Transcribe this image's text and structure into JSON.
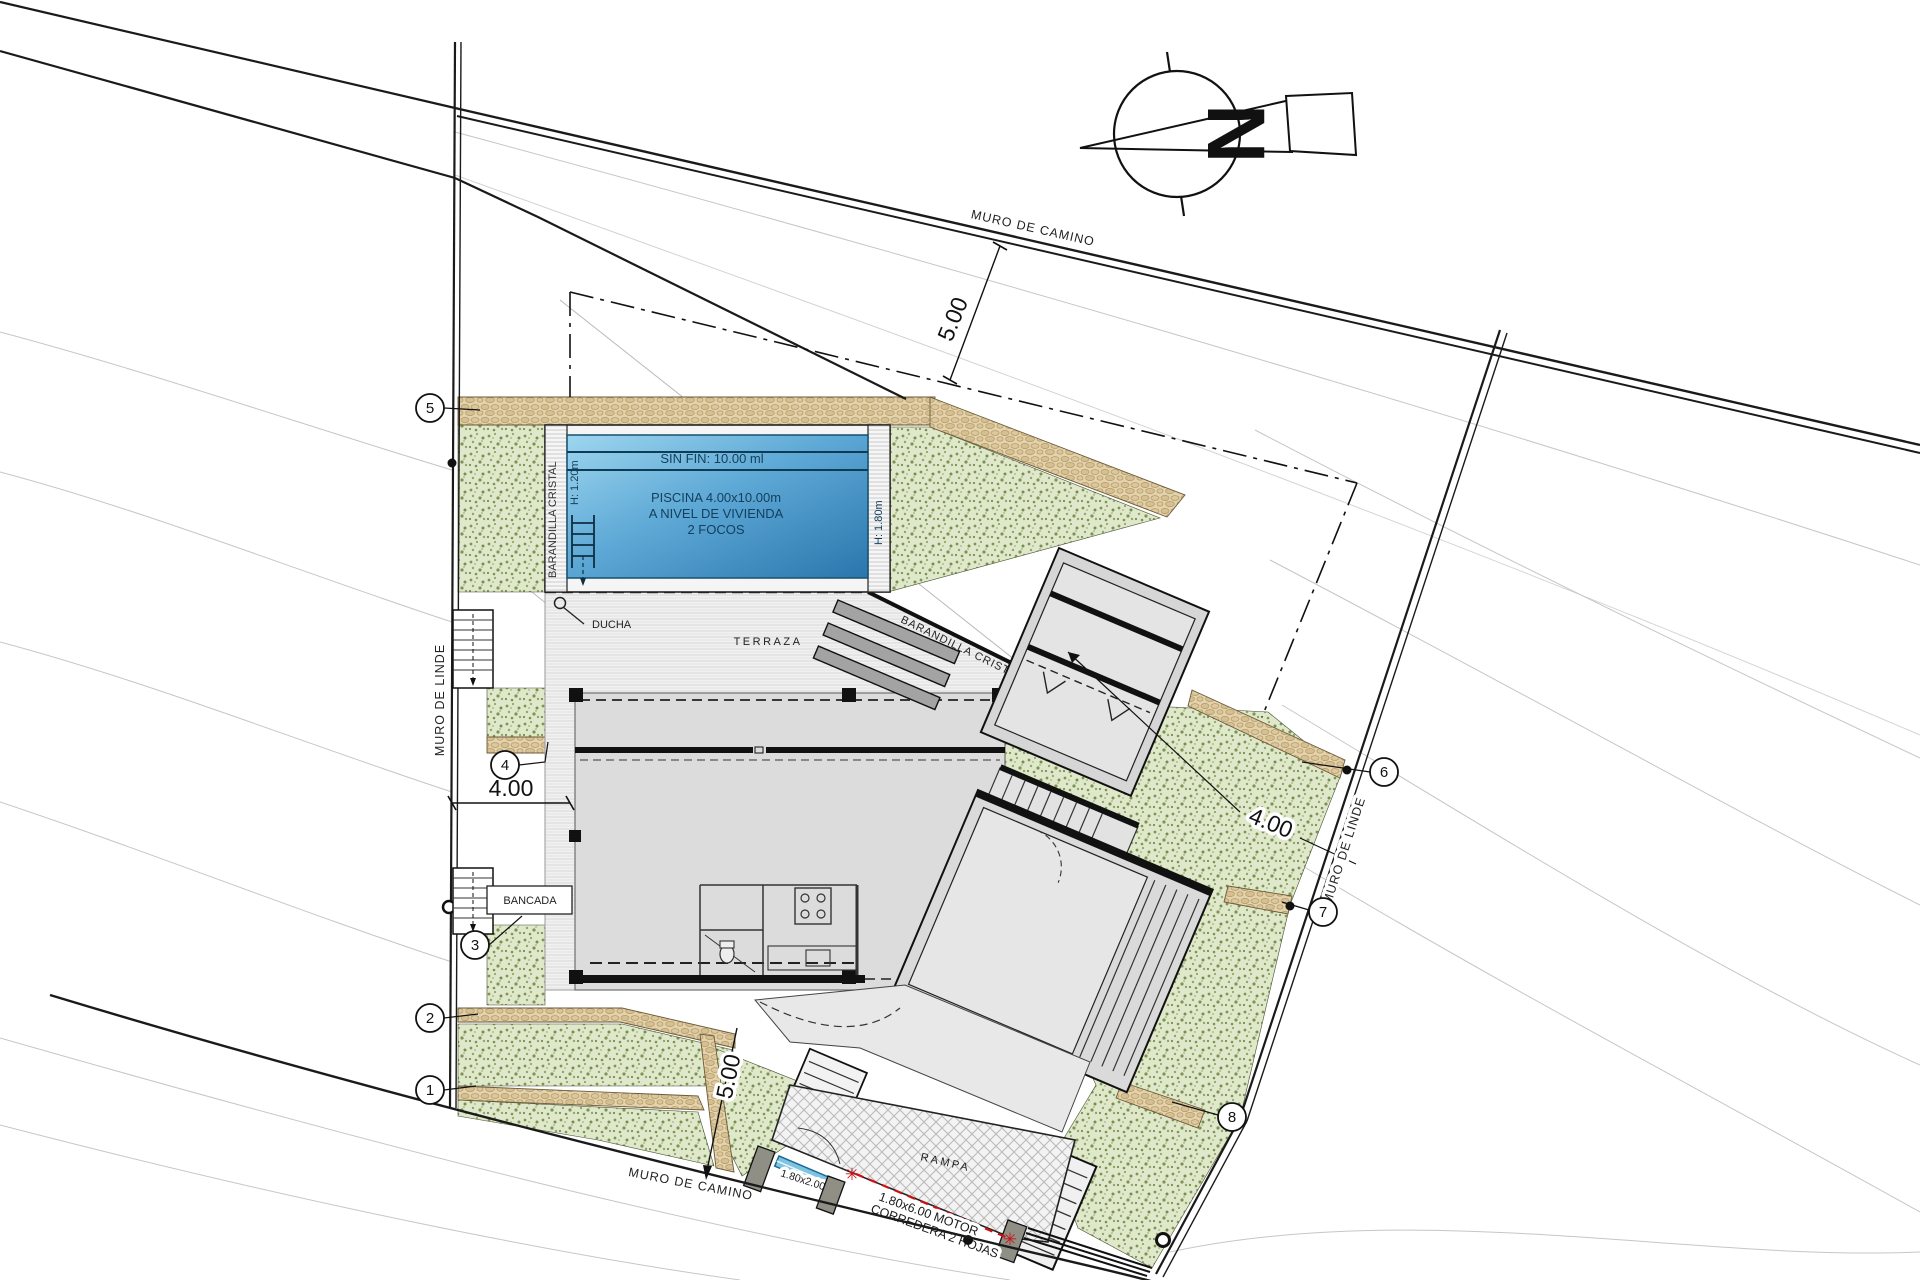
{
  "boundaries": {
    "top_road": "MURO DE CAMINO",
    "bottom_road": "MURO DE CAMINO",
    "left": "MURO DE LINDE",
    "right": "MURO DE LINDE"
  },
  "dimensions": {
    "top_setback": "5.00",
    "bottom_setback": "5.00",
    "left": "4.00",
    "right": "4.00"
  },
  "pool": {
    "edge": "SIN FIN: 10.00 ml",
    "name": "PISCINA 4.00x10.00m",
    "level": "A NIVEL DE VIVIENDA",
    "lights": "2 FOCOS",
    "rail": "BARANDILLA CRISTAL",
    "h_left": "H: 1.20m",
    "h_right": "H: 1.80m"
  },
  "terrace": {
    "label": "TERRAZA",
    "rail": "BARANDILLA CRISTAL",
    "shower": "DUCHA"
  },
  "site": {
    "bench": "BANCADA",
    "ramp": "RAMPA",
    "gate_small": "1.80x2.00",
    "gate_motor_line1": "1.80x6.00 MOTOR",
    "gate_motor_line2": "CORREDERA 2 HOJAS"
  },
  "markers": [
    "1",
    "2",
    "3",
    "4",
    "5",
    "6",
    "7",
    "8"
  ],
  "compass": {
    "letter": "N"
  },
  "colors": {
    "vegetation": "#dfe7c9",
    "vegetation_dot": "#7d9455",
    "wall_stone": "#e4d2aa",
    "pool_blue": "#5da8d4",
    "accent_red": "#cc1111",
    "house_gray": "#dcdcdc"
  }
}
